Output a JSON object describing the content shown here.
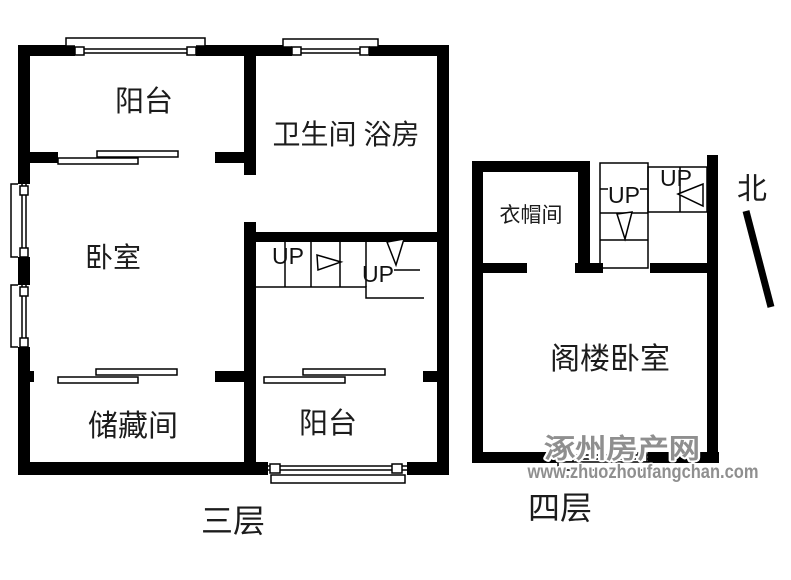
{
  "floor3": {
    "caption": "三层",
    "rooms": {
      "balcony_top": "阳台",
      "bathroom": "卫生间 浴房",
      "bedroom": "卧室",
      "storage": "储藏间",
      "balcony_bottom": "阳台"
    },
    "stairs": {
      "up_label_1": "UP",
      "up_label_2": "UP"
    }
  },
  "floor4": {
    "caption": "四层",
    "rooms": {
      "cloakroom": "衣帽间",
      "attic_bedroom": "阁楼卧室"
    },
    "stairs": {
      "up_label_1": "UP",
      "up_label_2": "UP"
    }
  },
  "compass": {
    "north_label": "北"
  },
  "watermark": {
    "site_name": "涿州房产网",
    "site_url": "www.zhuozhoufangchan.com"
  },
  "colors": {
    "wall": "#000000",
    "watermark_fill": "#8f8f8f",
    "watermark_outline": "#ffffff"
  }
}
